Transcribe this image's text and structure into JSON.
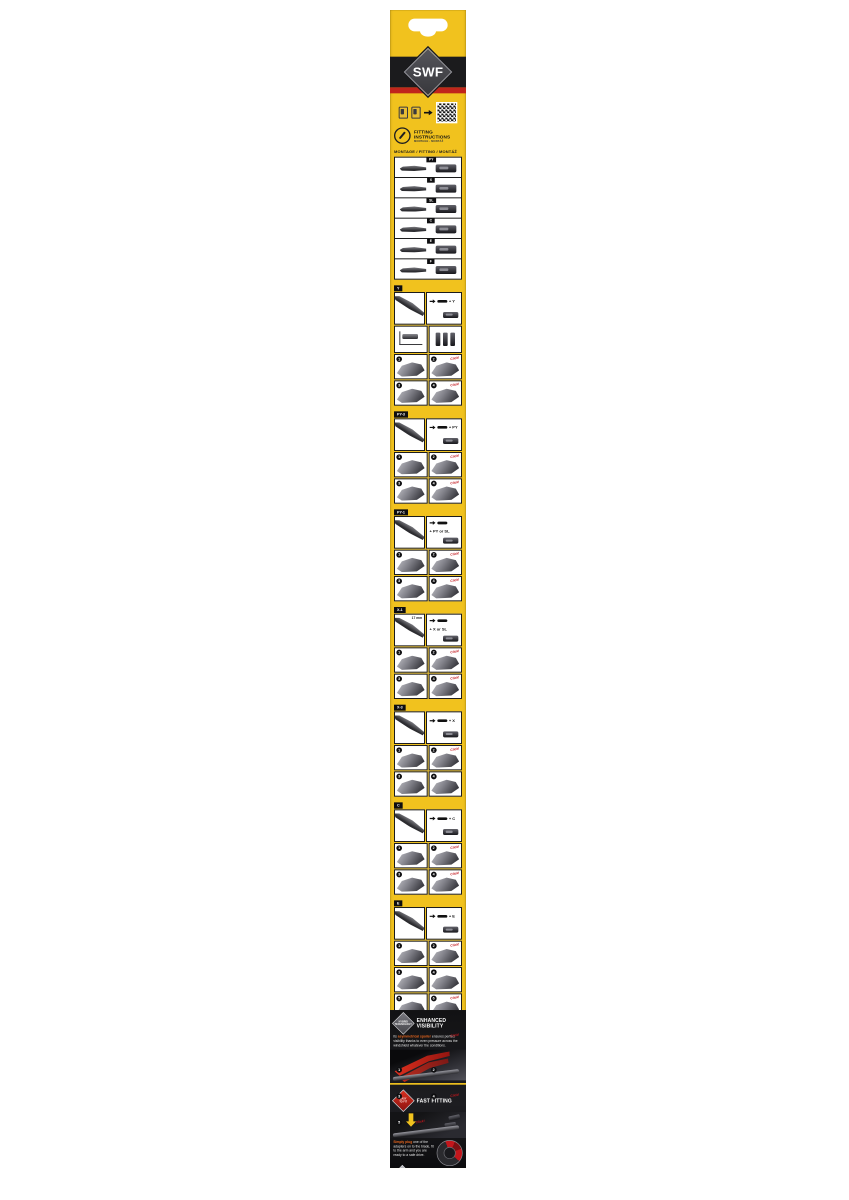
{
  "colors": {
    "brand_yellow": "#F1C21E",
    "band_black": "#1B1B1D",
    "stripe_red": "#C0251C",
    "logo_diamond_gray": "#47474B",
    "accent_click_red": "#C3161C",
    "accent_orange": "#E8661E",
    "panel_white": "#FFFFFF"
  },
  "header": {
    "logo": "SWF"
  },
  "intro": {
    "title": "FITTING INSTRUCTIONS",
    "subtitle": "MONTAGE · MONTÁŽ"
  },
  "montage_heading": "MONTAGE / FITTING / MONTÁŽ",
  "overview": {
    "rows": [
      {
        "label": "PY"
      },
      {
        "label": "X"
      },
      {
        "label": "SL"
      },
      {
        "label": "C"
      },
      {
        "label": "E"
      },
      {
        "label": "F"
      }
    ]
  },
  "sections": [
    {
      "label": "Y",
      "formula": "+ Y",
      "extra_row": true,
      "steps": [
        {
          "n": "1"
        },
        {
          "n": "2",
          "note": "Click!"
        },
        {
          "n": "3"
        },
        {
          "n": "4",
          "note": "Click!"
        }
      ]
    },
    {
      "label": "PY-3",
      "formula": "+ PY",
      "steps": [
        {
          "n": "1"
        },
        {
          "n": "2",
          "note": "Click!"
        },
        {
          "n": "3"
        },
        {
          "n": "4",
          "note": "Click!"
        }
      ]
    },
    {
      "label": "PY-1",
      "formula": "+ PY or SL",
      "steps": [
        {
          "n": "1"
        },
        {
          "n": "2",
          "note": "Click!"
        },
        {
          "n": "3"
        },
        {
          "n": "4",
          "note": "Click!"
        }
      ]
    },
    {
      "label": "X-1",
      "formula": "+ X or SL",
      "measurement": "17 mm",
      "steps": [
        {
          "n": "1"
        },
        {
          "n": "2",
          "note": "Click!"
        },
        {
          "n": "3"
        },
        {
          "n": "4",
          "note": "Click!"
        }
      ]
    },
    {
      "label": "X-3",
      "formula": "+ X",
      "steps": [
        {
          "n": "1"
        },
        {
          "n": "2",
          "note": "Click!"
        },
        {
          "n": "3"
        },
        {
          "n": "4"
        }
      ]
    },
    {
      "label": "C",
      "formula": "+ C",
      "steps": [
        {
          "n": "1"
        },
        {
          "n": "2",
          "note": "Click!"
        },
        {
          "n": "3"
        },
        {
          "n": "4",
          "note": "Click!"
        }
      ]
    },
    {
      "label": "E",
      "formula": "+ E",
      "steps": [
        {
          "n": "1"
        },
        {
          "n": "2",
          "note": "Click!"
        },
        {
          "n": "3"
        },
        {
          "n": "4"
        },
        {
          "n": "5"
        },
        {
          "n": "6",
          "note": "Click!"
        }
      ]
    },
    {
      "label": "F",
      "formula": "+ F",
      "formula_note": "Click!",
      "steps": [
        {
          "n": "1"
        },
        {
          "n": "2"
        },
        {
          "n": "3"
        },
        {
          "n": "4",
          "note": "Click!"
        },
        {
          "n": "5",
          "note": "Click!"
        }
      ]
    }
  ],
  "features": {
    "hybrid_badge_line1": "HYBRID",
    "hybrid_badge_line2": "TECHNOLOGY",
    "visibility_title": "ENHANCED VISIBILITY",
    "visibility_prefix": "Its",
    "visibility_highlight": "asymmetrical spoiler",
    "visibility_text": "ensures perfect visibility thanks to even pressure across the windshield whatever the conditions.",
    "easy_badge_line1": "EASY",
    "easy_badge_line2": "TO FIT",
    "fitting_title": "FAST FITTING",
    "fitting_highlight": "Simply plug",
    "fitting_text": "one of the adapters on to the blade, fit to the arm and you are ready to a safe drive."
  },
  "footer": {
    "text": "SWF a brand belonging to",
    "logo": "Valeo"
  }
}
